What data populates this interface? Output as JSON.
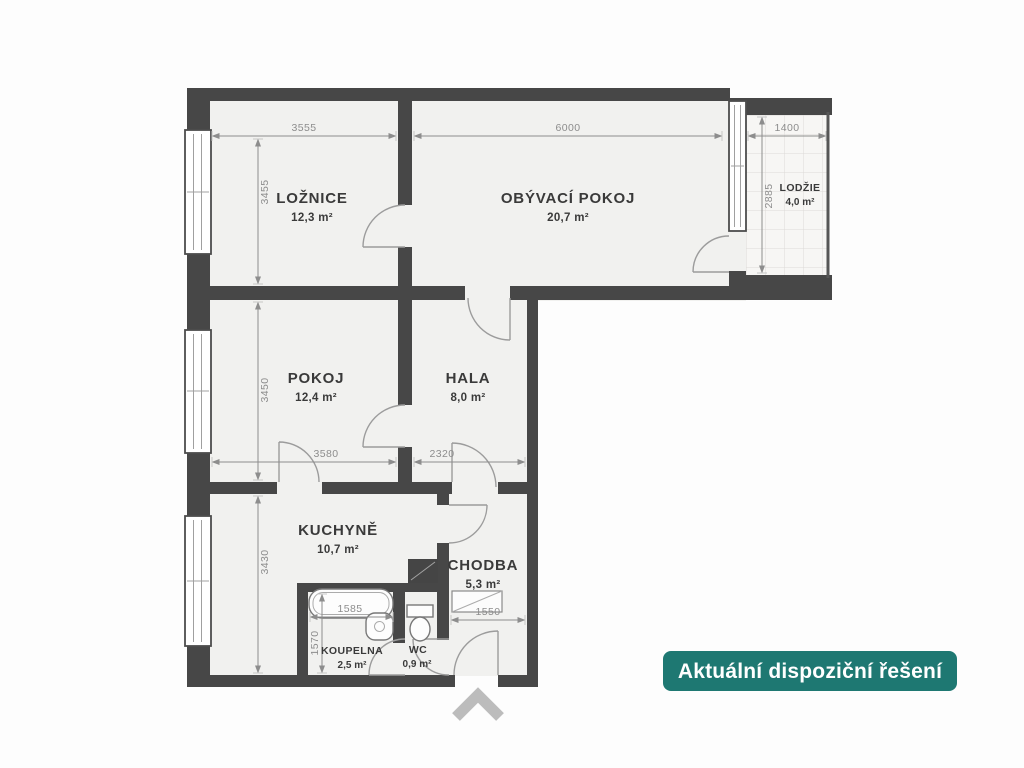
{
  "plan": {
    "rooms": {
      "loznice": {
        "name": "LOŽNICE",
        "area": "12,3 m²"
      },
      "obyvaci_pokoj": {
        "name": "OBÝVACÍ POKOJ",
        "area": "20,7 m²"
      },
      "lodzie": {
        "name": "LODŽIE",
        "area": "4,0 m²"
      },
      "pokoj": {
        "name": "POKOJ",
        "area": "12,4 m²"
      },
      "hala": {
        "name": "HALA",
        "area": "8,0 m²"
      },
      "kuchyne": {
        "name": "KUCHYNĚ",
        "area": "10,7 m²"
      },
      "chodba": {
        "name": "CHODBA",
        "area": "5,3 m²"
      },
      "koupelna": {
        "name": "KOUPELNA",
        "area": "2,5 m²"
      },
      "wc": {
        "name": "WC",
        "area": "0,9 m²"
      }
    },
    "dims": {
      "loznice_w": "3555",
      "obyvaci_w": "6000",
      "lodzie_w": "1400",
      "loznice_h": "3455",
      "lodzie_h": "2885",
      "pokoj_h": "3450",
      "pokoj_w": "3580",
      "hala_w": "2320",
      "kuchyne_h": "3430",
      "koupelna_w": "1585",
      "koupelna_h": "1570",
      "chodba_w": "1550"
    }
  },
  "badge": {
    "label": "Aktuální dispoziční řešení"
  },
  "icons": {
    "entrance_arrow": "chevron-up-icon"
  },
  "palette": {
    "wall": "#474747",
    "floor": "#f1f1ef",
    "line": "#9c9c9c",
    "dim": "#8d8d8d",
    "label": "#3a3a3a",
    "badge": "#1e7872",
    "badge-text": "#ffffff",
    "chevron": "#bcbcbc",
    "tile": "#f7f6f4",
    "tile-line": "#dcdad7",
    "fixture": "#787878",
    "window-frame": "#4d4d4d"
  }
}
